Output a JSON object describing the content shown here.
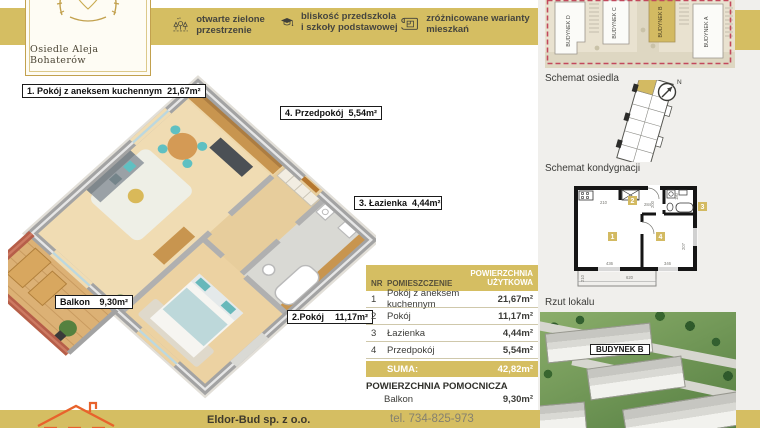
{
  "brand": {
    "monogram": "AB",
    "name": "Osiedle Aleja Bohaterów"
  },
  "features": [
    {
      "icon": "trees-icon",
      "label": "otwarte zielone przestrzenie"
    },
    {
      "icon": "graduation-cap-icon",
      "label": "bliskość przedszkola i szkoły podstawowej"
    },
    {
      "icon": "blueprint-icon",
      "label": "zróżnicowane warianty mieszkań"
    }
  ],
  "site_plan": {
    "buildings": [
      {
        "name": "BUDYNEK D",
        "highlighted": false
      },
      {
        "name": "BUDYNEK C",
        "highlighted": false
      },
      {
        "name": "BUDYNEK B",
        "highlighted": true
      },
      {
        "name": "BUDYNEK A",
        "highlighted": false
      }
    ]
  },
  "sections": {
    "estate_schema_label": "Schemat osiedla",
    "floor_schema_label": "Schemat kondygnacji",
    "unit_plan_label": "Rzut lokalu"
  },
  "compass": {
    "north_label": "N"
  },
  "plan_labels": [
    {
      "name": "1. Pokój z aneksem kuchennym",
      "area": "21,67m²"
    },
    {
      "name": "4. Przedpokój",
      "area": "5,54m²"
    },
    {
      "name": "3. Łazienka",
      "area": "4,44m²"
    },
    {
      "name": "2.Pokój",
      "area": "11,17m²"
    },
    {
      "name": "Balkon",
      "area": "9,30m²"
    }
  ],
  "floor_plan_2d": {
    "room_numbers": [
      "1",
      "2",
      "3",
      "4"
    ],
    "dimensions": [
      "210",
      "284",
      "200",
      "180",
      "436",
      "346",
      "207",
      "210",
      "620"
    ]
  },
  "area_table": {
    "header": {
      "nr": "NR",
      "room": "POMIESZCZENIE",
      "area": "POWIERZCHNIA UŻYTKOWA"
    },
    "rows": [
      {
        "nr": "1",
        "room": "Pokój z aneksem kuchennym",
        "area": "21,67m²"
      },
      {
        "nr": "2",
        "room": "Pokój",
        "area": "11,17m²"
      },
      {
        "nr": "3",
        "room": "Łazienka",
        "area": "4,44m²"
      },
      {
        "nr": "4",
        "room": "Przedpokój",
        "area": "5,54m²"
      }
    ],
    "sum": {
      "label": "SUMA:",
      "value": "42,82m²"
    },
    "auxiliary": {
      "title": "POWIERZCHNIA POMOCNICZA",
      "row": {
        "room": "Balkon",
        "area": "9,30m²"
      }
    }
  },
  "render": {
    "building_label": "BUDYNEK B"
  },
  "footer": {
    "company": "Eldor-Bud sp. z o.o.",
    "phone": "tel. 734-825-973"
  },
  "colors": {
    "gold": "#d5be62",
    "boundary_red": "#c2485c",
    "logo_gold": "#c2a14e",
    "footer_orange": "#e8632c",
    "teal_accent": "#5fc0c2",
    "brick": "#b65e49"
  }
}
